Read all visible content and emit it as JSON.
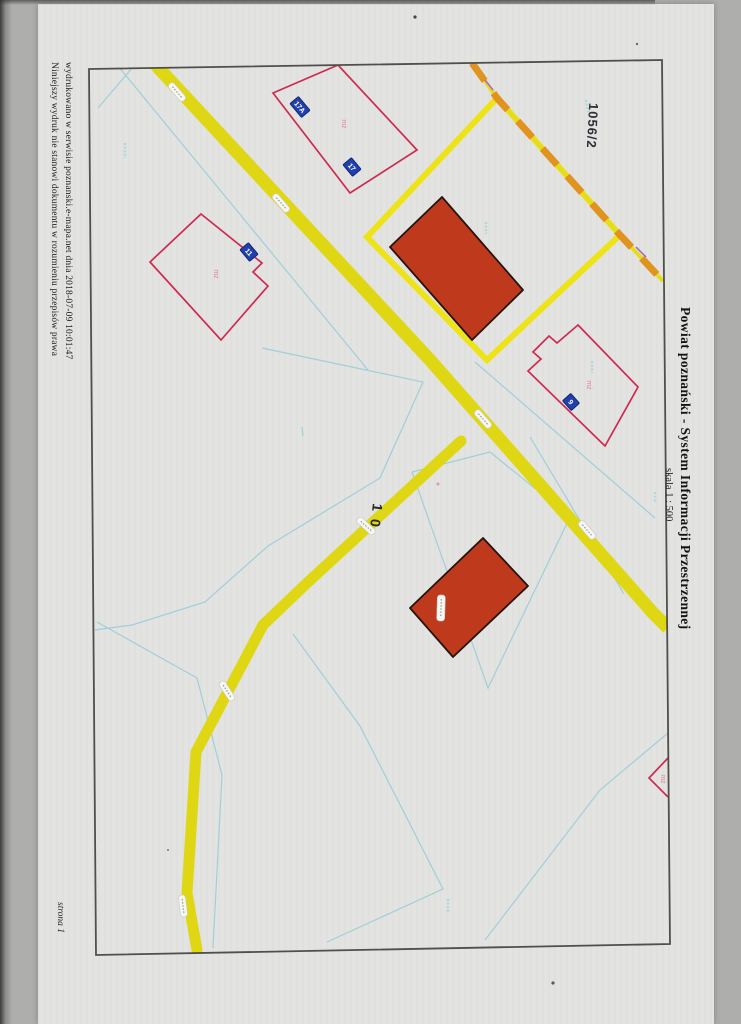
{
  "document": {
    "title": "Powiat poznański - System Informacji Przestrzennej",
    "scale_label": "skala 1 : 500",
    "disclaimer_line1": "Niniejszy wydruk nie stanowi dokumentu w rozumieniu przepisów prawa",
    "disclaimer_line2": "wydrukowano w serwisie poznanski.e-mapa.net dnia 2018-07-09 10:01:47",
    "page_label": "strona 1"
  },
  "map": {
    "parcel_number": "1056/2",
    "road_parcel_number": "1 0",
    "buildings": {
      "b_17a": "17A",
      "b_17": "17",
      "b_11": "11",
      "b_9": "9"
    },
    "usage_label": "mż",
    "colors": {
      "road_yellow": "#e0d714",
      "boundary_yellow": "#eee316",
      "dashed_orange": "#e1931f",
      "building_red": "#bf3a1d",
      "building_outline_crimson": "#cf2a50",
      "parcel_line_cyan": "#a0cfd9",
      "address_label_blue": "#2040b0"
    }
  }
}
